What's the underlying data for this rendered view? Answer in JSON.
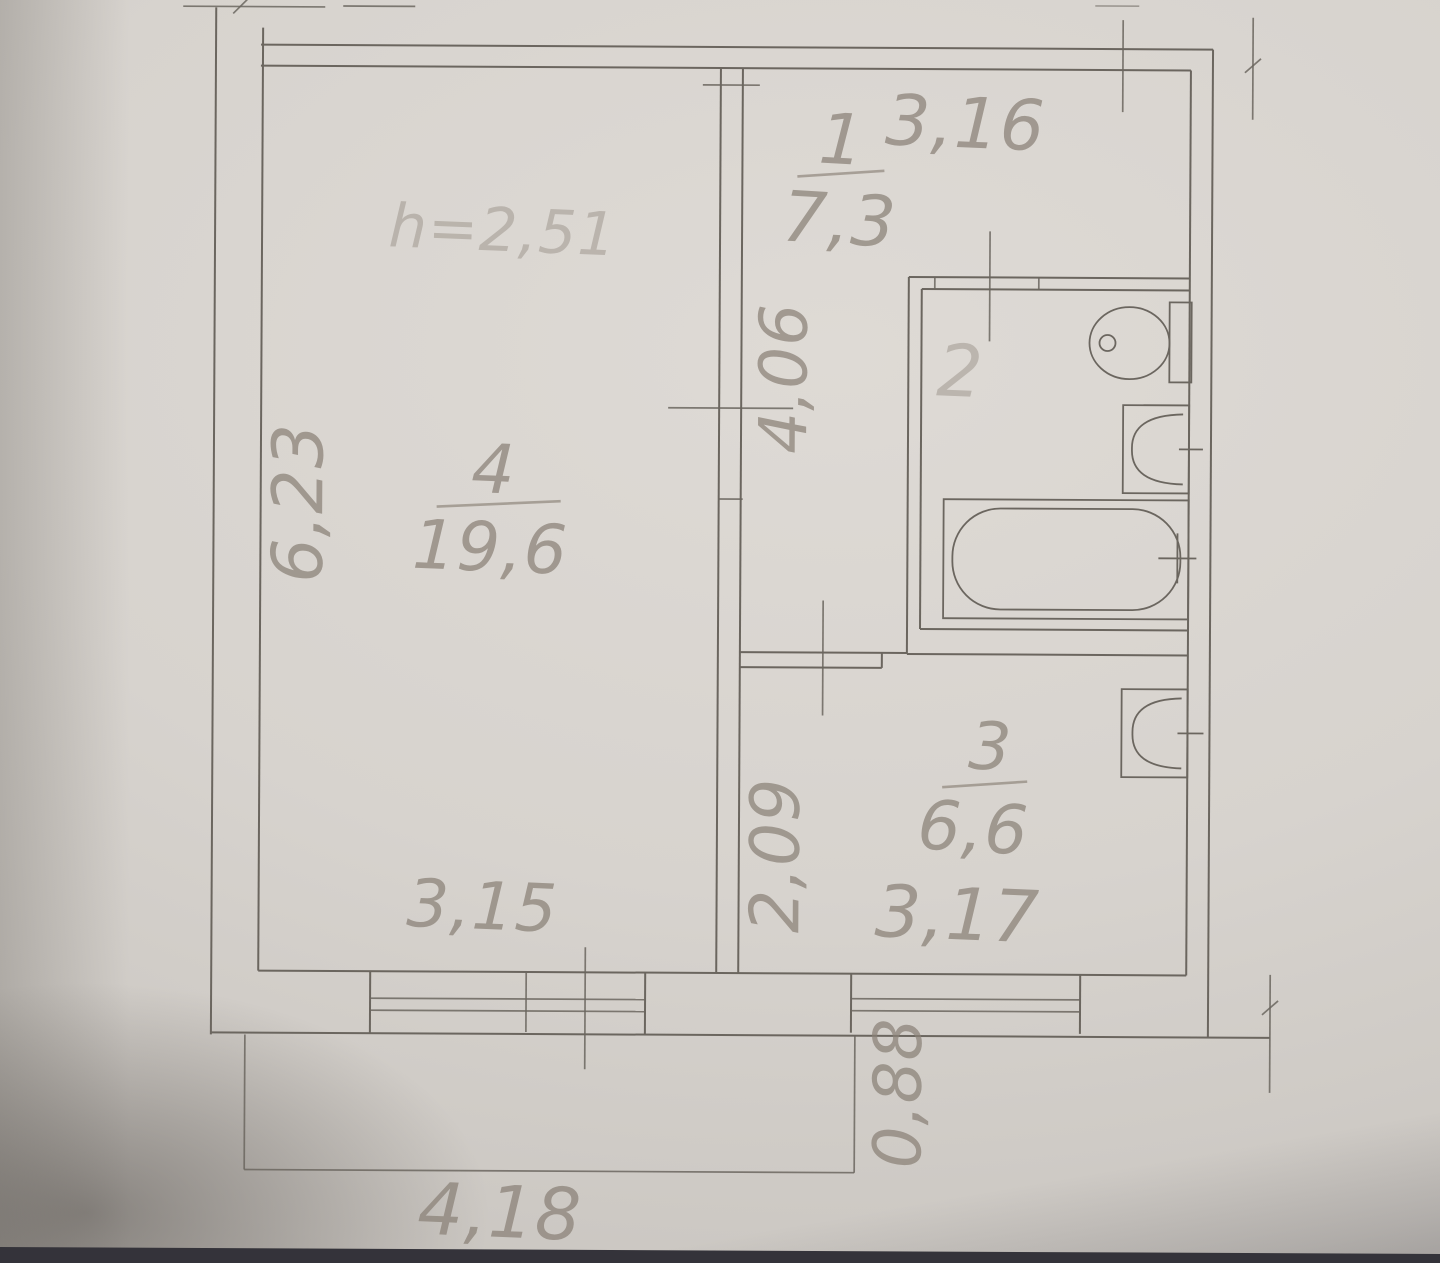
{
  "colors": {
    "paper": "#d7d3ce",
    "ink": "#6b665f",
    "pencil": "#8a8177",
    "shadow": "#34333a"
  },
  "plan": {
    "ceiling_height": "h=2,51",
    "rooms": [
      {
        "number": "1",
        "area": "7,3"
      },
      {
        "number": "2"
      },
      {
        "number": "3",
        "area": "6,6"
      },
      {
        "number": "4",
        "area": "19,6"
      }
    ],
    "dimensions": {
      "hall_top_width": "3,16",
      "hall_left_height": "4,06",
      "living_left_height": "6,23",
      "living_bottom_width": "3,15",
      "kitchen_left_height": "2,09",
      "kitchen_bottom_width": "3,17",
      "balcony_bottom_width": "4,18",
      "balcony_right_depth": "0,88"
    }
  }
}
